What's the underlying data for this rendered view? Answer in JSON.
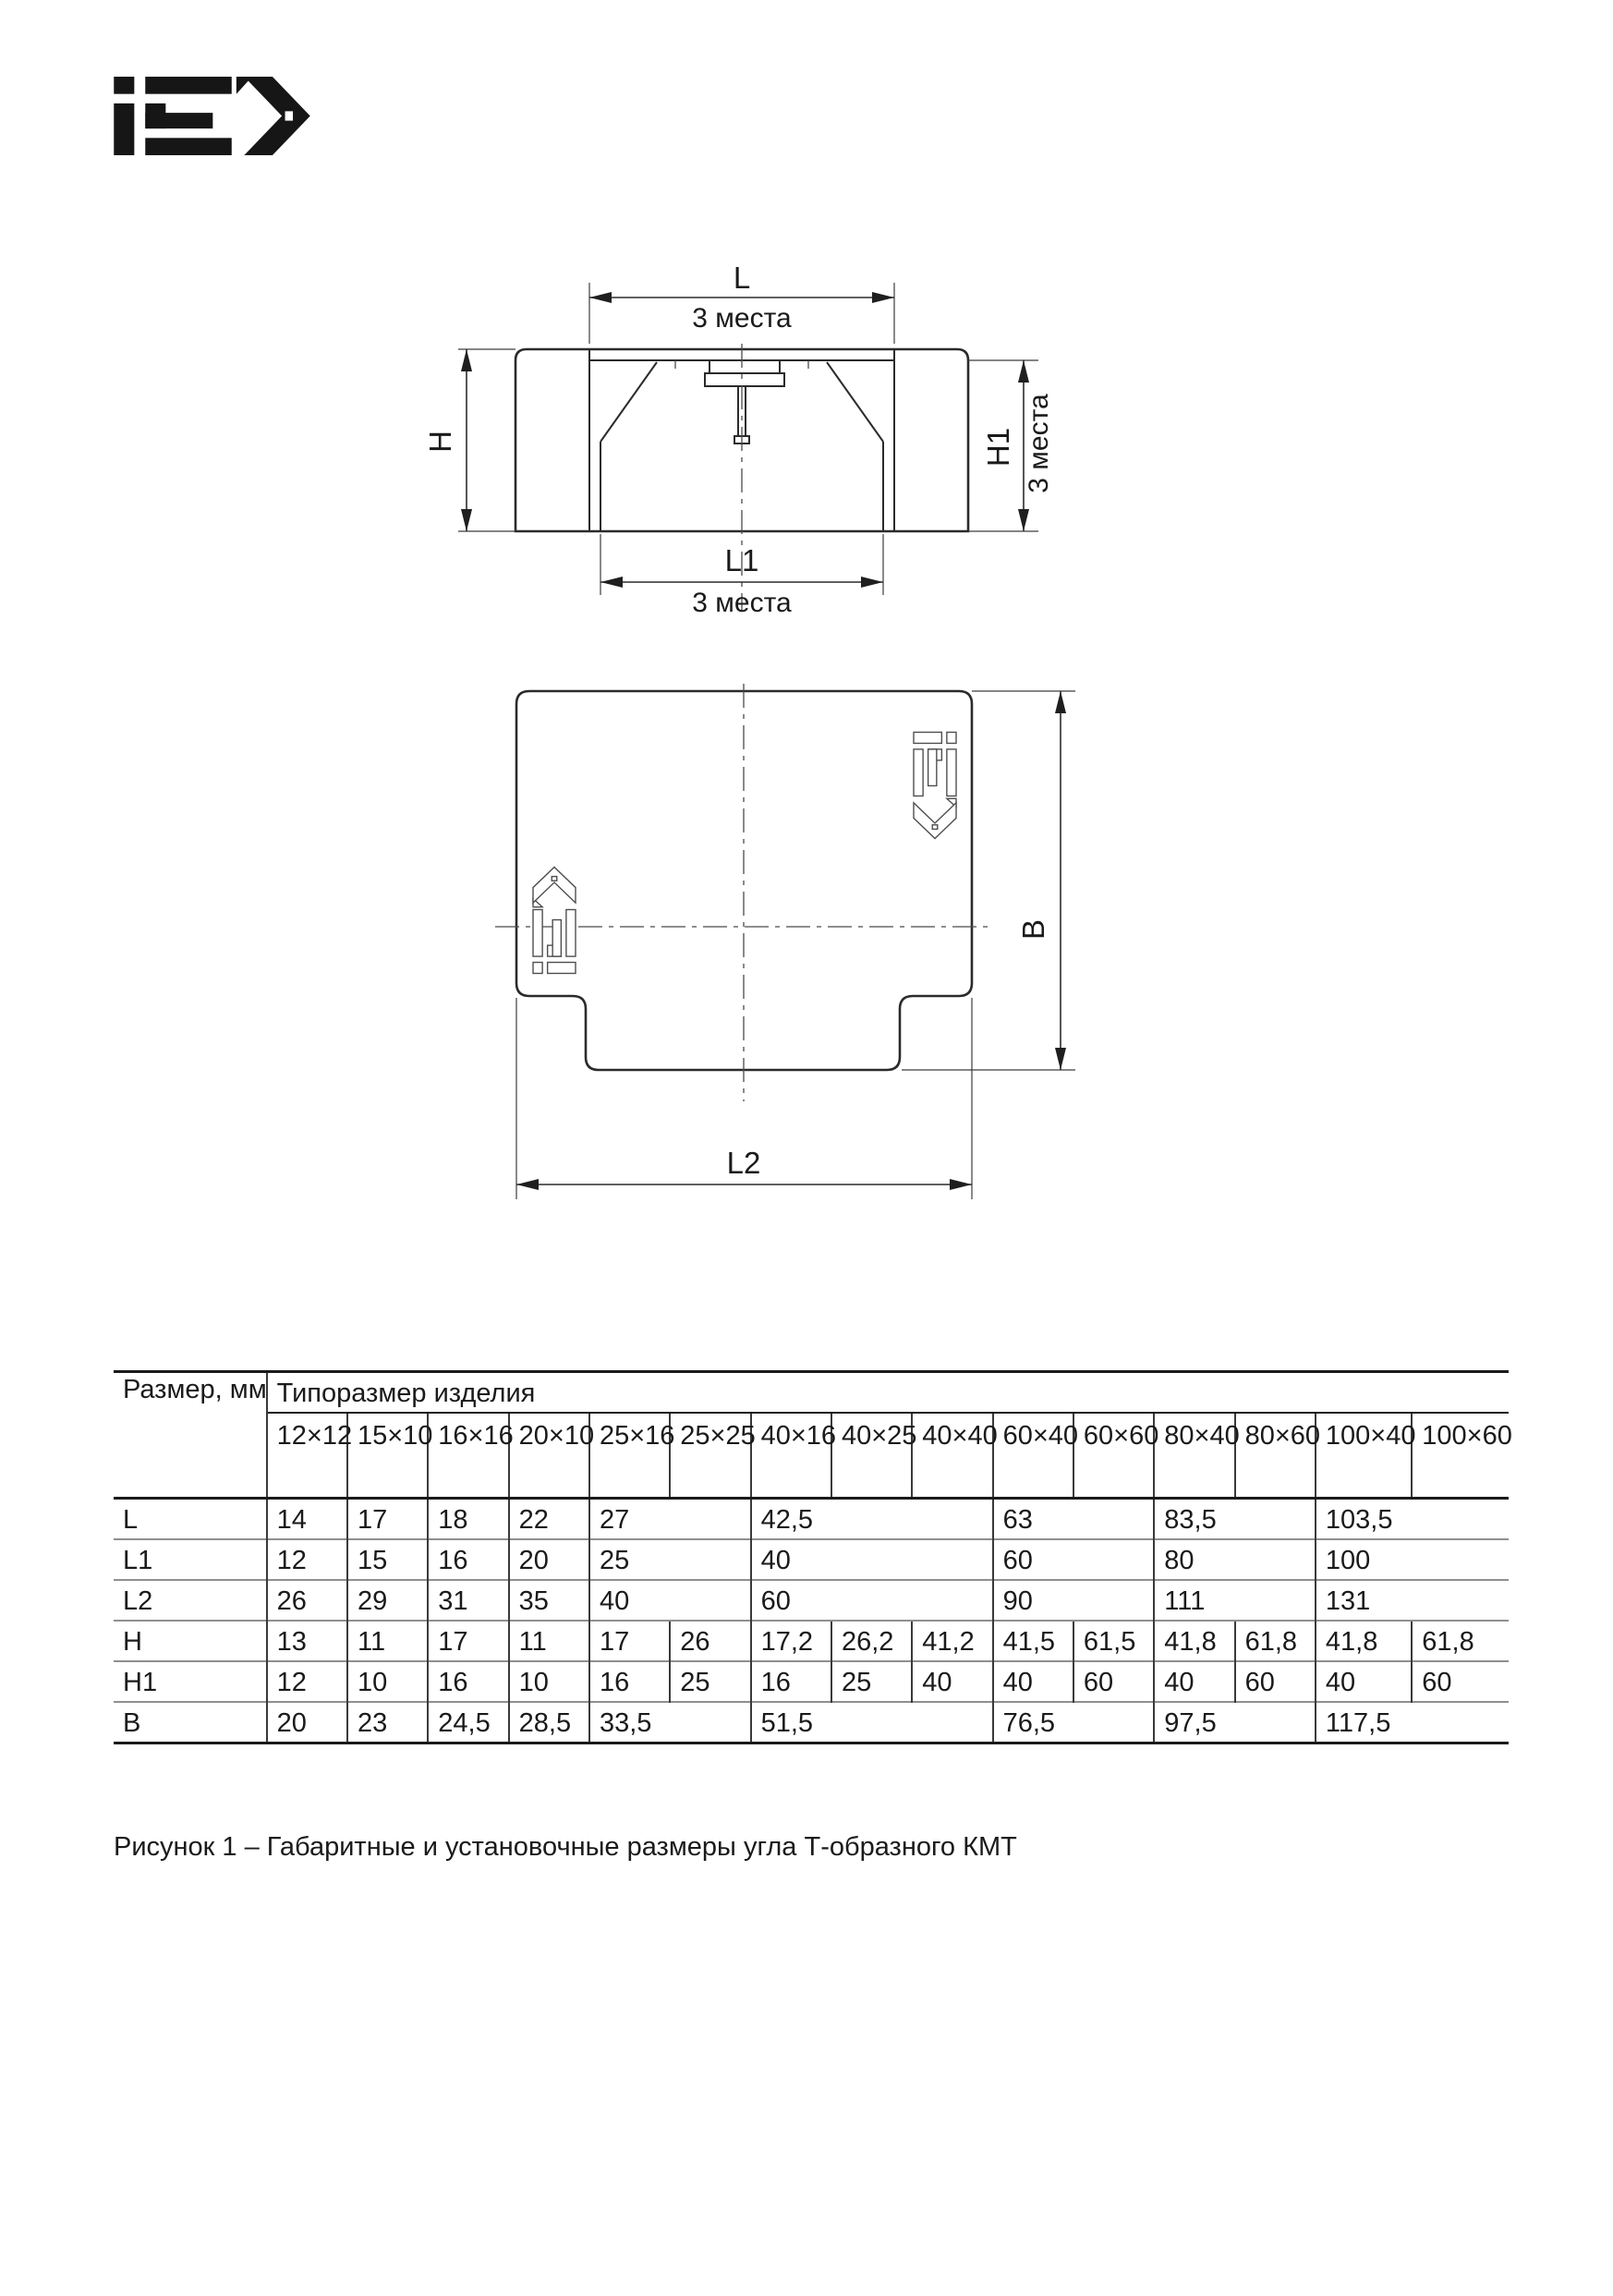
{
  "brand": {
    "name": "IEK"
  },
  "drawings": {
    "front": {
      "dim_l": "L",
      "dim_l_places": "3 места",
      "dim_l1": "L1",
      "dim_l1_places": "3 места",
      "dim_h": "H",
      "dim_h1": "H1",
      "dim_h1_places": "3 места"
    },
    "top": {
      "dim_l2": "L2",
      "dim_b": "B"
    }
  },
  "table": {
    "corner_header": "Размер, мм",
    "group_header": "Типоразмер изделия",
    "sizes": [
      "12×12",
      "15×10",
      "16×16",
      "20×10",
      "25×16",
      "25×25",
      "40×16",
      "40×25",
      "40×40",
      "60×40",
      "60×60",
      "80×40",
      "80×60",
      "100×40",
      "100×60"
    ],
    "rows": [
      {
        "name": "L",
        "cells": [
          {
            "v": "14"
          },
          {
            "v": "17"
          },
          {
            "v": "18"
          },
          {
            "v": "22"
          },
          {
            "v": "27",
            "span": 2
          },
          {
            "v": "42,5",
            "span": 3
          },
          {
            "v": "63",
            "span": 2
          },
          {
            "v": "83,5",
            "span": 2
          },
          {
            "v": "103,5",
            "span": 2
          }
        ]
      },
      {
        "name": "L1",
        "cells": [
          {
            "v": "12"
          },
          {
            "v": "15"
          },
          {
            "v": "16"
          },
          {
            "v": "20"
          },
          {
            "v": "25",
            "span": 2
          },
          {
            "v": "40",
            "span": 3
          },
          {
            "v": "60",
            "span": 2
          },
          {
            "v": "80",
            "span": 2
          },
          {
            "v": "100",
            "span": 2
          }
        ]
      },
      {
        "name": "L2",
        "cells": [
          {
            "v": "26"
          },
          {
            "v": "29"
          },
          {
            "v": "31"
          },
          {
            "v": "35"
          },
          {
            "v": "40",
            "span": 2
          },
          {
            "v": "60",
            "span": 3
          },
          {
            "v": "90",
            "span": 2
          },
          {
            "v": "111",
            "span": 2
          },
          {
            "v": "131",
            "span": 2
          }
        ]
      },
      {
        "name": "H",
        "cells": [
          {
            "v": "13"
          },
          {
            "v": "11"
          },
          {
            "v": "17"
          },
          {
            "v": "11"
          },
          {
            "v": "17"
          },
          {
            "v": "26"
          },
          {
            "v": "17,2"
          },
          {
            "v": "26,2"
          },
          {
            "v": "41,2"
          },
          {
            "v": "41,5"
          },
          {
            "v": "61,5"
          },
          {
            "v": "41,8"
          },
          {
            "v": "61,8"
          },
          {
            "v": "41,8"
          },
          {
            "v": "61,8"
          }
        ]
      },
      {
        "name": "H1",
        "cells": [
          {
            "v": "12"
          },
          {
            "v": "10"
          },
          {
            "v": "16"
          },
          {
            "v": "10"
          },
          {
            "v": "16"
          },
          {
            "v": "25"
          },
          {
            "v": "16"
          },
          {
            "v": "25"
          },
          {
            "v": "40"
          },
          {
            "v": "40"
          },
          {
            "v": "60"
          },
          {
            "v": "40"
          },
          {
            "v": "60"
          },
          {
            "v": "40"
          },
          {
            "v": "60"
          }
        ]
      },
      {
        "name": "B",
        "cells": [
          {
            "v": "20"
          },
          {
            "v": "23"
          },
          {
            "v": "24,5"
          },
          {
            "v": "28,5"
          },
          {
            "v": "33,5",
            "span": 2
          },
          {
            "v": "51,5",
            "span": 3
          },
          {
            "v": "76,5",
            "span": 2
          },
          {
            "v": "97,5",
            "span": 2
          },
          {
            "v": "117,5",
            "span": 2
          }
        ]
      }
    ]
  },
  "caption": "Рисунок 1 – Габаритные и установочные размеры угла Т-образного КМТ"
}
